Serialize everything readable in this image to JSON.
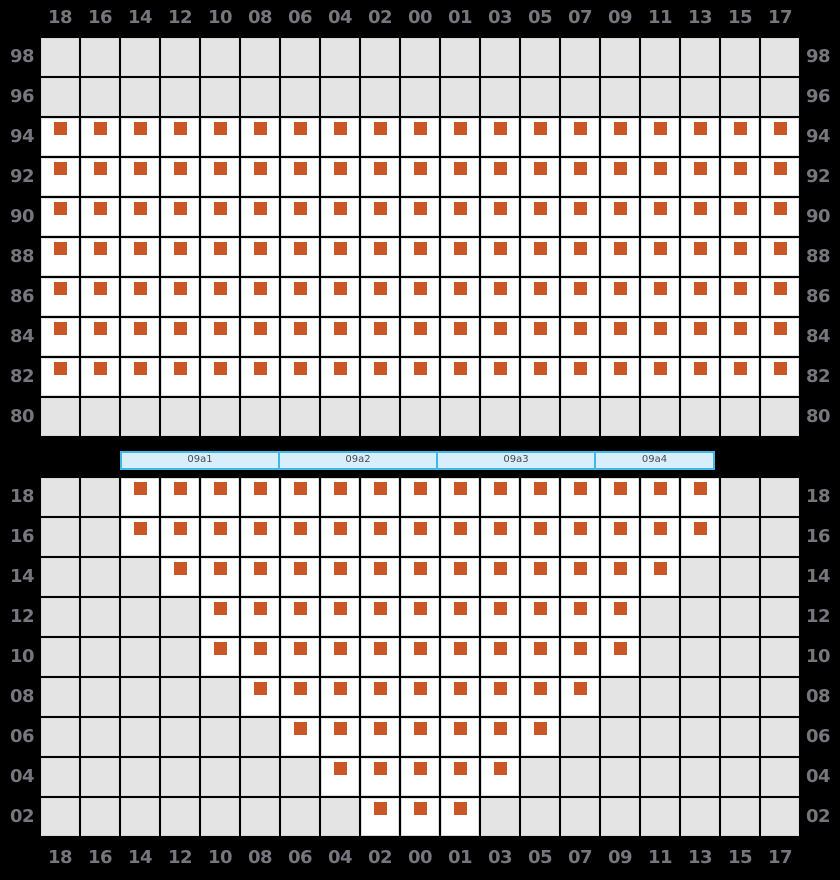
{
  "columns": [
    "18",
    "16",
    "14",
    "12",
    "10",
    "08",
    "06",
    "04",
    "02",
    "00",
    "01",
    "03",
    "05",
    "07",
    "09",
    "11",
    "13",
    "15",
    "17"
  ],
  "upper_grid": {
    "rows": [
      {
        "label": "98",
        "cells": "0000000000000000000"
      },
      {
        "label": "96",
        "cells": "0000000000000000000"
      },
      {
        "label": "94",
        "cells": "1111111111111111111"
      },
      {
        "label": "92",
        "cells": "1111111111111111111"
      },
      {
        "label": "90",
        "cells": "1111111111111111111"
      },
      {
        "label": "88",
        "cells": "1111111111111111111"
      },
      {
        "label": "86",
        "cells": "1111111111111111111"
      },
      {
        "label": "84",
        "cells": "1111111111111111111"
      },
      {
        "label": "82",
        "cells": "1111111111111111111"
      },
      {
        "label": "80",
        "cells": "0000000000000000000"
      }
    ]
  },
  "section_bar": {
    "segments": [
      {
        "label": "09a1"
      },
      {
        "label": "09a2"
      },
      {
        "label": "09a3"
      },
      {
        "label": "09a4"
      }
    ]
  },
  "lower_grid": {
    "rows": [
      {
        "label": "18",
        "cells": "0011111111111111100"
      },
      {
        "label": "16",
        "cells": "0011111111111111100"
      },
      {
        "label": "14",
        "cells": "0001111111111111000"
      },
      {
        "label": "12",
        "cells": "0000111111111110000"
      },
      {
        "label": "10",
        "cells": "0000111111111110000"
      },
      {
        "label": "08",
        "cells": "0000011111111100000"
      },
      {
        "label": "06",
        "cells": "0000001111111000000"
      },
      {
        "label": "04",
        "cells": "0000000111110000000"
      },
      {
        "label": "02",
        "cells": "0000000011100000000"
      }
    ]
  },
  "colors": {
    "background": "#000000",
    "seat_available_marker": "#ca5628",
    "cell_available": "#ffffff",
    "cell_unavailable": "#e4e4e5",
    "grid_line": "#d9d9db",
    "label_text": "#76767c",
    "section_bar_border": "#3fb8e9",
    "section_bar_fill": "#d8eefa",
    "section_bar_text": "#4a4a4a"
  }
}
